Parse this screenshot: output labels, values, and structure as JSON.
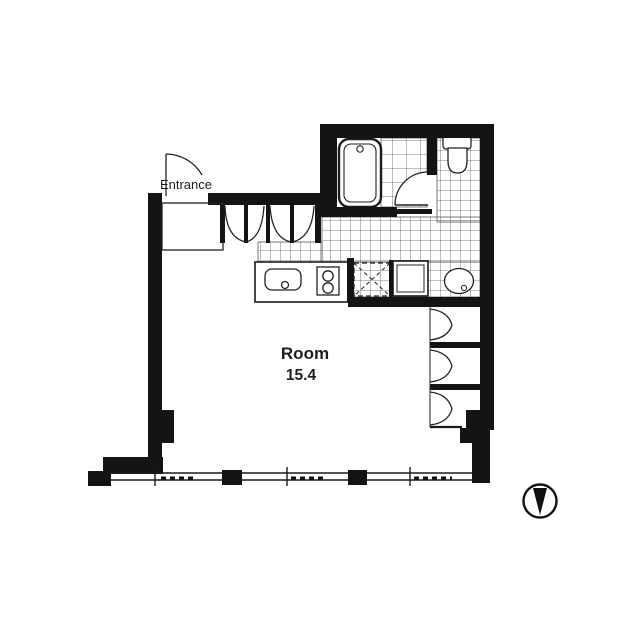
{
  "floorplan": {
    "labels": {
      "entrance": "Entrance",
      "room_name": "Room",
      "room_area": "15.4"
    },
    "colors": {
      "wall": "#141414",
      "line": "#222222",
      "tile_line": "#565656",
      "background": "#ffffff"
    },
    "compass": {
      "needle_direction": "down"
    },
    "fixtures": [
      "entrance-door",
      "entrance-vestibule",
      "hallway-closet-doors",
      "bathtub",
      "bathroom-door",
      "toilet",
      "wash-basin",
      "washing-machine",
      "refrigerator-space",
      "kitchen-counter",
      "kitchen-sink",
      "gas-stove",
      "wardrobe-closet",
      "balcony-windows",
      "compass"
    ]
  }
}
